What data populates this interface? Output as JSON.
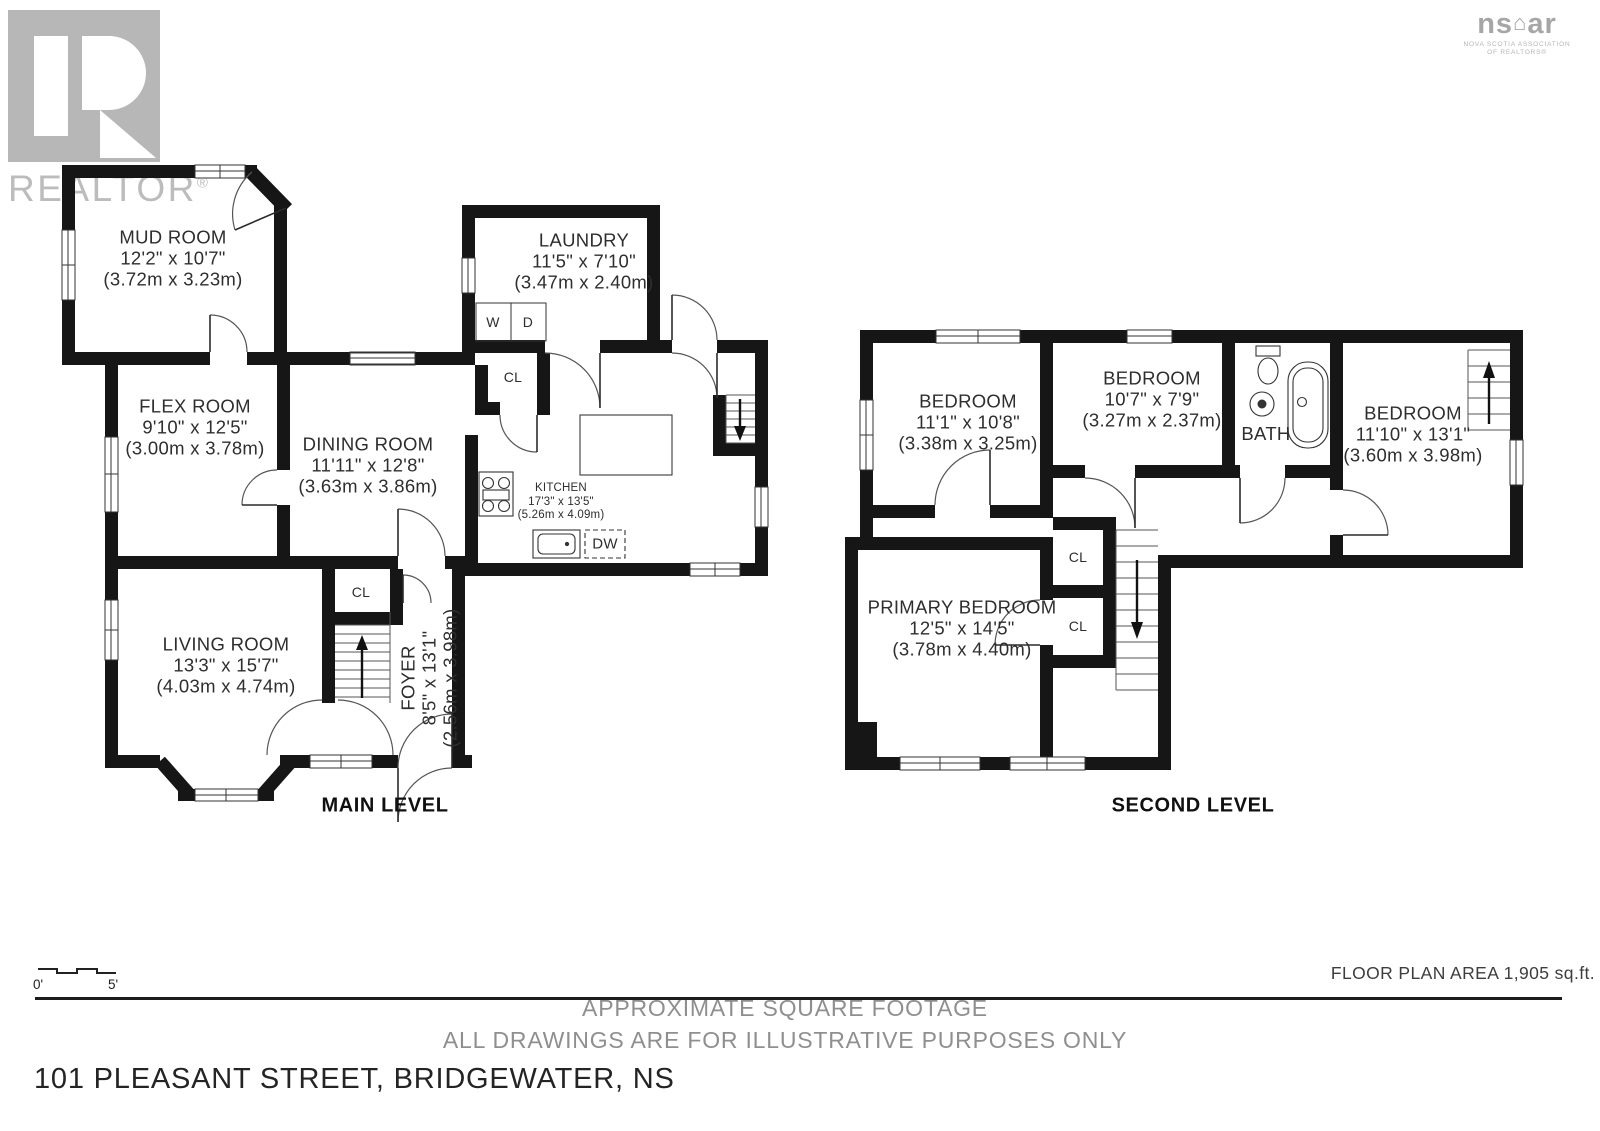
{
  "branding": {
    "realtor_logo_text": "REALTOR",
    "realtor_reg": "®",
    "nsar_left": "ns",
    "nsar_right": "ar",
    "nsar_sub1": "NOVA SCOTIA ASSOCIATION",
    "nsar_sub2": "OF REALTORS®"
  },
  "plans": {
    "main": {
      "level_label": "MAIN LEVEL",
      "rooms": {
        "mud": {
          "name": "MUD ROOM",
          "dims": "12'2\" x 10'7\"",
          "metric": "(3.72m x 3.23m)"
        },
        "laundry": {
          "name": "LAUNDRY",
          "dims": "11'5\" x 7'10\"",
          "metric": "(3.47m x 2.40m)"
        },
        "flex": {
          "name": "FLEX ROOM",
          "dims": "9'10\" x 12'5\"",
          "metric": "(3.00m x 3.78m)"
        },
        "dining": {
          "name": "DINING ROOM",
          "dims": "11'11\" x 12'8\"",
          "metric": "(3.63m x 3.86m)"
        },
        "kitchen": {
          "name": "KITCHEN",
          "dims": "17'3\" x 13'5\"",
          "metric": "(5.26m x 4.09m)"
        },
        "living": {
          "name": "LIVING ROOM",
          "dims": "13'3\" x 15'7\"",
          "metric": "(4.03m x 4.74m)"
        },
        "foyer": {
          "name": "FOYER",
          "dims": "8'5\" x 13'1\"",
          "metric": "(2.56m x 3.98m)"
        }
      },
      "tags": {
        "washer": "W",
        "dryer": "D",
        "dishwasher": "DW",
        "closet_hall": "CL",
        "closet_foyer": "CL"
      }
    },
    "second": {
      "level_label": "SECOND LEVEL",
      "rooms": {
        "bedroom1": {
          "name": "BEDROOM",
          "dims": "11'1\" x 10'8\"",
          "metric": "(3.38m x 3.25m)"
        },
        "bedroom2": {
          "name": "BEDROOM",
          "dims": "10'7\" x 7'9\"",
          "metric": "(3.27m x 2.37m)"
        },
        "bedroom3": {
          "name": "BEDROOM",
          "dims": "11'10\" x 13'1\"",
          "metric": "(3.60m x 3.98m)"
        },
        "primary": {
          "name": "PRIMARY BEDROOM",
          "dims": "12'5\" x 14'5\"",
          "metric": "(3.78m x 4.40m)"
        },
        "bath": {
          "name": "BATH"
        }
      },
      "tags": {
        "closet_upper": "CL",
        "closet_lower": "CL"
      }
    }
  },
  "scale_bar": {
    "start": "0'",
    "end": "5'"
  },
  "footer": {
    "area_note": "FLOOR PLAN AREA 1,905 sq.ft.",
    "line1": "APPROXIMATE SQUARE FOOTAGE",
    "line2": "ALL DRAWINGS ARE FOR ILLUSTRATIVE PURPOSES ONLY",
    "address": "101 PLEASANT STREET, BRIDGEWATER, NS"
  }
}
